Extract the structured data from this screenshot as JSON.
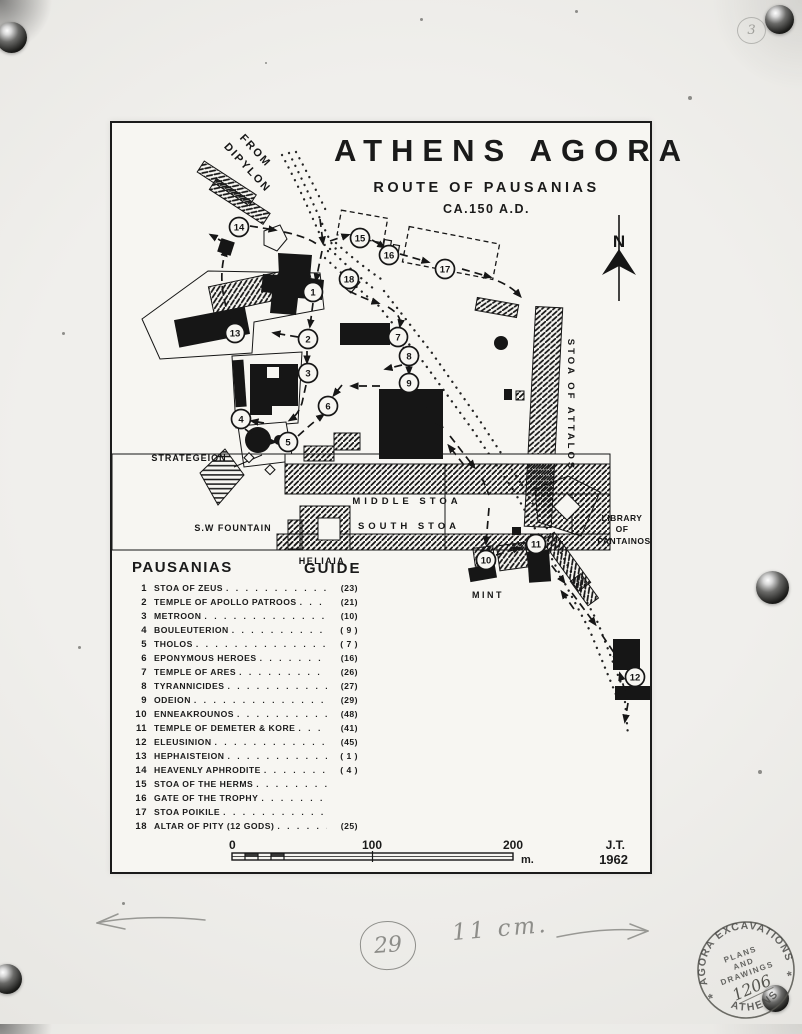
{
  "photo": {
    "corner_number": "3"
  },
  "sheet": {
    "title": "ATHENS AGORA",
    "subtitle": "ROUTE OF PAUSANIAS",
    "date_line": "CA.150 A.D.",
    "credit_initials": "J.T.",
    "credit_year": "1962"
  },
  "map": {
    "ink_color": "#161616",
    "labels": [
      {
        "text": "FROM",
        "x": 141,
        "y": 30,
        "rot": 47,
        "size": 11,
        "ls": 2
      },
      {
        "text": "DIPYLON",
        "x": 133,
        "y": 47,
        "rot": 47,
        "size": 11,
        "ls": 2
      },
      {
        "text": "N",
        "x": 507,
        "y": 124,
        "rot": 0,
        "size": 17,
        "ls": 0
      },
      {
        "text": "STRATEGEION",
        "x": 77,
        "y": 338,
        "rot": 0,
        "size": 9,
        "ls": 1
      },
      {
        "text": "S.W FOUNTAIN",
        "x": 121,
        "y": 408,
        "rot": 0,
        "size": 9,
        "ls": 1
      },
      {
        "text": "MIDDLE STOA",
        "x": 295,
        "y": 381,
        "rot": 0,
        "size": 9.5,
        "ls": 4
      },
      {
        "text": "SOUTH STOA",
        "x": 297,
        "y": 406,
        "rot": 0,
        "size": 9.5,
        "ls": 4
      },
      {
        "text": "HELIAIA",
        "x": 210,
        "y": 441,
        "rot": 0,
        "size": 9,
        "ls": 1.5
      },
      {
        "text": "MINT",
        "x": 376,
        "y": 475,
        "rot": 0,
        "size": 9,
        "ls": 2.5
      },
      {
        "text": "STOA OF ATTALOS",
        "x": 456,
        "y": 282,
        "rot": 90,
        "size": 9.5,
        "ls": 3
      },
      {
        "text": "LIBRARY",
        "x": 510,
        "y": 398,
        "rot": 0,
        "size": 8.5,
        "ls": 0.5
      },
      {
        "text": "OF",
        "x": 510,
        "y": 409,
        "rot": 0,
        "size": 8.5,
        "ls": 0.5
      },
      {
        "text": "PANTAINOS",
        "x": 512,
        "y": 421,
        "rot": 0,
        "size": 8.5,
        "ls": 0.5
      }
    ],
    "markers": [
      {
        "n": "1",
        "x": 201,
        "y": 169
      },
      {
        "n": "2",
        "x": 196,
        "y": 216
      },
      {
        "n": "3",
        "x": 196,
        "y": 250
      },
      {
        "n": "4",
        "x": 129,
        "y": 296
      },
      {
        "n": "5",
        "x": 176,
        "y": 319
      },
      {
        "n": "6",
        "x": 216,
        "y": 283
      },
      {
        "n": "7",
        "x": 286,
        "y": 214
      },
      {
        "n": "8",
        "x": 297,
        "y": 233
      },
      {
        "n": "9",
        "x": 297,
        "y": 260
      },
      {
        "n": "10",
        "x": 374,
        "y": 437
      },
      {
        "n": "11",
        "x": 424,
        "y": 421
      },
      {
        "n": "12",
        "x": 523,
        "y": 554
      },
      {
        "n": "13",
        "x": 123,
        "y": 210
      },
      {
        "n": "14",
        "x": 127,
        "y": 104
      },
      {
        "n": "15",
        "x": 248,
        "y": 115
      },
      {
        "n": "16",
        "x": 277,
        "y": 132
      },
      {
        "n": "17",
        "x": 333,
        "y": 146
      },
      {
        "n": "18",
        "x": 237,
        "y": 156
      }
    ]
  },
  "legend": {
    "header_left": "PAUSANIAS",
    "header_right": "GUIDE",
    "items": [
      {
        "num": "1",
        "name": "STOA OF ZEUS",
        "ref": "(23)"
      },
      {
        "num": "2",
        "name": "TEMPLE OF APOLLO PATROOS",
        "ref": "(21)"
      },
      {
        "num": "3",
        "name": "METROON",
        "ref": "(10)"
      },
      {
        "num": "4",
        "name": "BOULEUTERION",
        "ref": "( 9 )"
      },
      {
        "num": "5",
        "name": "THOLOS",
        "ref": "( 7 )"
      },
      {
        "num": "6",
        "name": "EPONYMOUS HEROES",
        "ref": "(16)"
      },
      {
        "num": "7",
        "name": "TEMPLE OF ARES",
        "ref": "(26)"
      },
      {
        "num": "8",
        "name": "TYRANNICIDES",
        "ref": "(27)"
      },
      {
        "num": "9",
        "name": "ODEION",
        "ref": "(29)"
      },
      {
        "num": "10",
        "name": "ENNEAKROUNOS",
        "ref": "(48)"
      },
      {
        "num": "11",
        "name": "TEMPLE OF DEMETER & KORE",
        "ref": "(41)"
      },
      {
        "num": "12",
        "name": "ELEUSINION",
        "ref": "(45)"
      },
      {
        "num": "13",
        "name": "HEPHAISTEION",
        "ref": "( 1 )"
      },
      {
        "num": "14",
        "name": "HEAVENLY APHRODITE",
        "ref": "( 4 )"
      },
      {
        "num": "15",
        "name": "STOA OF THE HERMS",
        "ref": ""
      },
      {
        "num": "16",
        "name": "GATE OF THE TROPHY",
        "ref": ""
      },
      {
        "num": "17",
        "name": "STOA POIKILE",
        "ref": ""
      },
      {
        "num": "18",
        "name": "ALTAR OF PITY (12 GODS)",
        "ref": "(25)"
      }
    ]
  },
  "scalebar": {
    "tick0": "0",
    "tick100": "100",
    "tick200": "200",
    "unit": "m."
  },
  "annotations": {
    "circled_number": "29",
    "size_note": "11 cm.",
    "stamp": {
      "arc_top": "AGORA  EXCAVATIONS",
      "arc_bottom": "ATHENS",
      "star": "*",
      "line1": "PLANS",
      "line2": "AND",
      "line3": "DRAWINGS",
      "number": "1206"
    }
  }
}
